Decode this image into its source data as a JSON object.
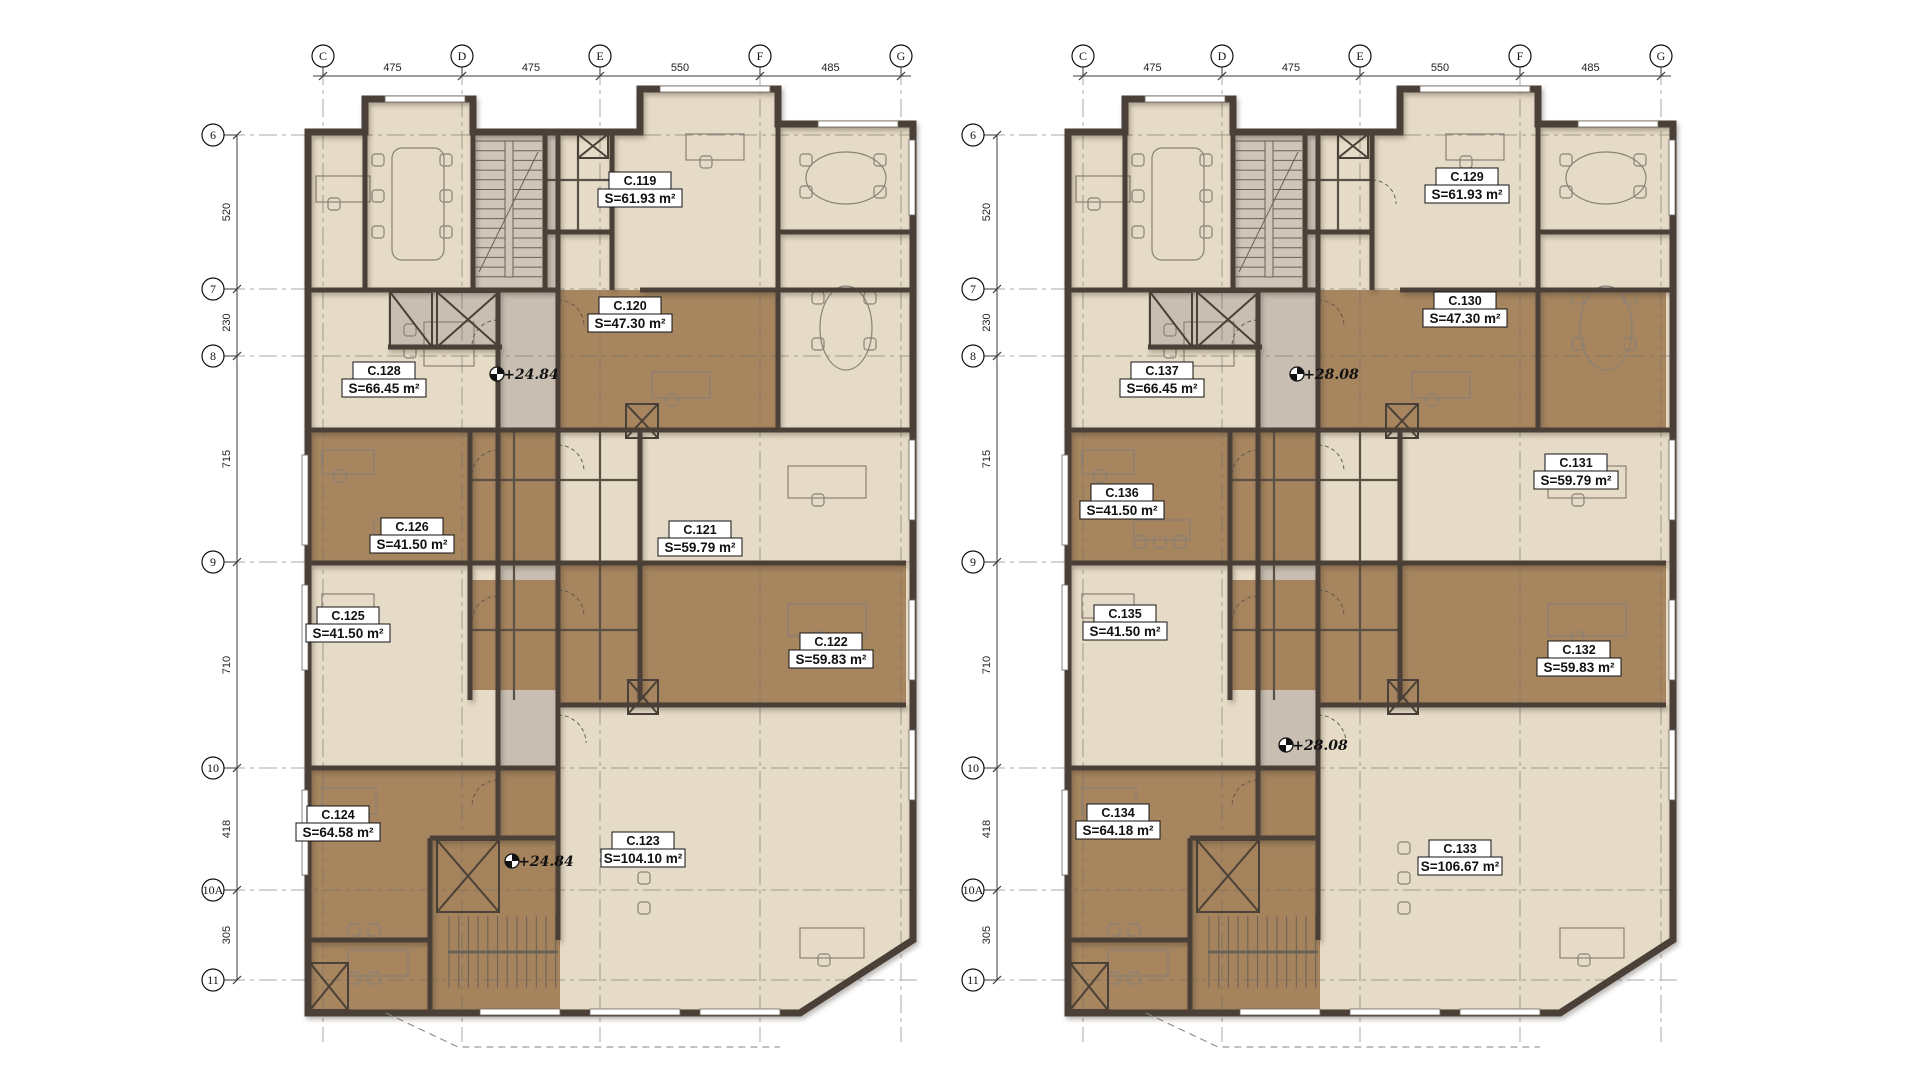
{
  "drawing": {
    "type": "architectural floor plan",
    "units_note": "m²"
  },
  "colors": {
    "paper": "#ffffff",
    "floor": "#e6dbc6",
    "floor_warm": "#ddd0ba",
    "brown": "#a17e56",
    "brown_dark": "#8f6f4c",
    "gray": "#c8bfb2",
    "gray_core": "#cfc6ba",
    "wall": "#4b4138",
    "thin_wall": "#5a5046",
    "furniture": "#8b8176",
    "gridline": "#77706a",
    "dimline": "#3a3a3a"
  },
  "grid": {
    "col_labels": [
      "C",
      "D",
      "E",
      "F",
      "G"
    ],
    "col_x": [
      323,
      462,
      600,
      760,
      901
    ],
    "col_dims": [
      "475",
      "475",
      "550",
      "485"
    ],
    "row_labels": [
      "6",
      "7",
      "8",
      "9",
      "10",
      "10A",
      "11"
    ],
    "row_y": [
      135,
      289,
      356,
      562,
      768,
      890,
      980
    ],
    "row_dims": [
      "520",
      "230",
      "715",
      "710",
      "418",
      "305"
    ]
  },
  "plans": [
    {
      "id": "left",
      "dx": 0,
      "row_bubble_x": 213,
      "row_dim_x": 237,
      "wide_brown": false,
      "rooms": [
        {
          "name": "C.119",
          "area": "S=61.93 m²",
          "x": 640,
          "y": 190
        },
        {
          "name": "C.120",
          "area": "S=47.30 m²",
          "x": 630,
          "y": 315
        },
        {
          "name": "C.128",
          "area": "S=66.45 m²",
          "x": 384,
          "y": 380
        },
        {
          "name": "C.126",
          "area": "S=41.50 m²",
          "x": 412,
          "y": 536
        },
        {
          "name": "C.121",
          "area": "S=59.79 m²",
          "x": 700,
          "y": 539
        },
        {
          "name": "C.125",
          "area": "S=41.50 m²",
          "x": 348,
          "y": 625
        },
        {
          "name": "C.122",
          "area": "S=59.83 m²",
          "x": 831,
          "y": 651
        },
        {
          "name": "C.124",
          "area": "S=64.58 m²",
          "x": 338,
          "y": 824
        },
        {
          "name": "C.123",
          "area": "S=104.10 m²",
          "x": 643,
          "y": 850
        }
      ],
      "levels": [
        {
          "text": "+24.84",
          "x": 497,
          "y": 374
        },
        {
          "text": "+24.84",
          "x": 512,
          "y": 861
        }
      ]
    },
    {
      "id": "right",
      "dx": 760,
      "row_bubble_x": 973,
      "row_dim_x": 997,
      "wide_brown": true,
      "rooms": [
        {
          "name": "C.129",
          "area": "S=61.93 m²",
          "x": 1467,
          "y": 186
        },
        {
          "name": "C.130",
          "area": "S=47.30 m²",
          "x": 1465,
          "y": 310
        },
        {
          "name": "C.137",
          "area": "S=66.45 m²",
          "x": 1162,
          "y": 380
        },
        {
          "name": "C.136",
          "area": "S=41.50 m²",
          "x": 1122,
          "y": 502
        },
        {
          "name": "C.131",
          "area": "S=59.79 m²",
          "x": 1576,
          "y": 472
        },
        {
          "name": "C.135",
          "area": "S=41.50 m²",
          "x": 1125,
          "y": 623
        },
        {
          "name": "C.132",
          "area": "S=59.83 m²",
          "x": 1579,
          "y": 659
        },
        {
          "name": "C.134",
          "area": "S=64.18 m²",
          "x": 1118,
          "y": 822
        },
        {
          "name": "C.133",
          "area": "S=106.67 m²",
          "x": 1460,
          "y": 858
        }
      ],
      "levels": [
        {
          "text": "+28.08",
          "x": 1297,
          "y": 374
        },
        {
          "text": "+28.08",
          "x": 1286,
          "y": 745
        }
      ]
    }
  ]
}
